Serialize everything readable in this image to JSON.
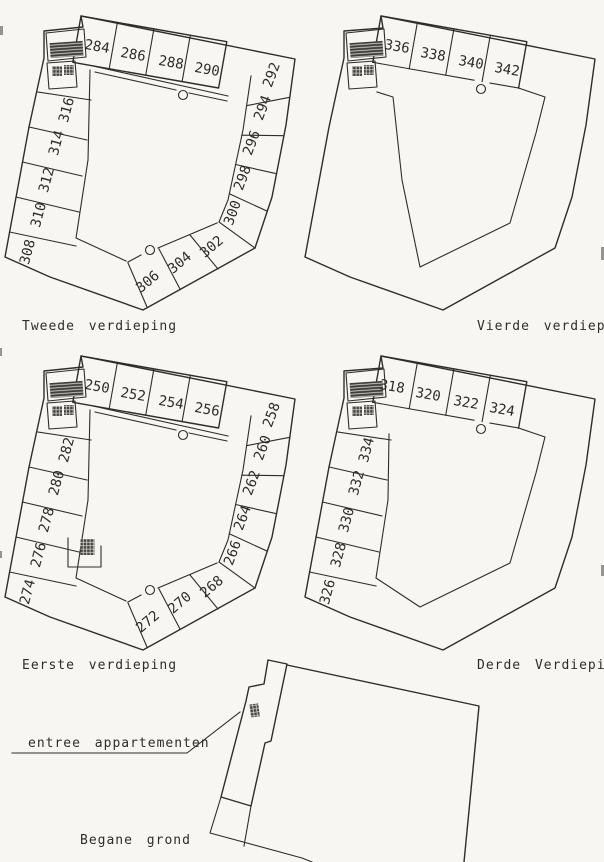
{
  "palette": {
    "background": "#f7f6f2",
    "ink": "#2e2d2b"
  },
  "floors": {
    "tweede": {
      "label": "Tweede verdieping",
      "rooms": [
        "284",
        "286",
        "288",
        "290",
        "292",
        "294",
        "296",
        "298",
        "300",
        "302",
        "304",
        "306",
        "308",
        "310",
        "312",
        "314",
        "316"
      ]
    },
    "vierde": {
      "label": "Vierde verdieping",
      "rooms": [
        "336",
        "338",
        "340",
        "342"
      ]
    },
    "eerste": {
      "label": "Eerste verdieping",
      "rooms": [
        "250",
        "252",
        "254",
        "256",
        "258",
        "260",
        "262",
        "264",
        "266",
        "268",
        "270",
        "272",
        "274",
        "276",
        "278",
        "280",
        "282"
      ]
    },
    "derde": {
      "label": "Derde Verdieping",
      "rooms": [
        "318",
        "320",
        "322",
        "324",
        "326",
        "328",
        "330",
        "332",
        "334"
      ]
    },
    "begane": {
      "label": "Begane grond"
    }
  },
  "annotations": {
    "entree": "entree appartementen"
  }
}
